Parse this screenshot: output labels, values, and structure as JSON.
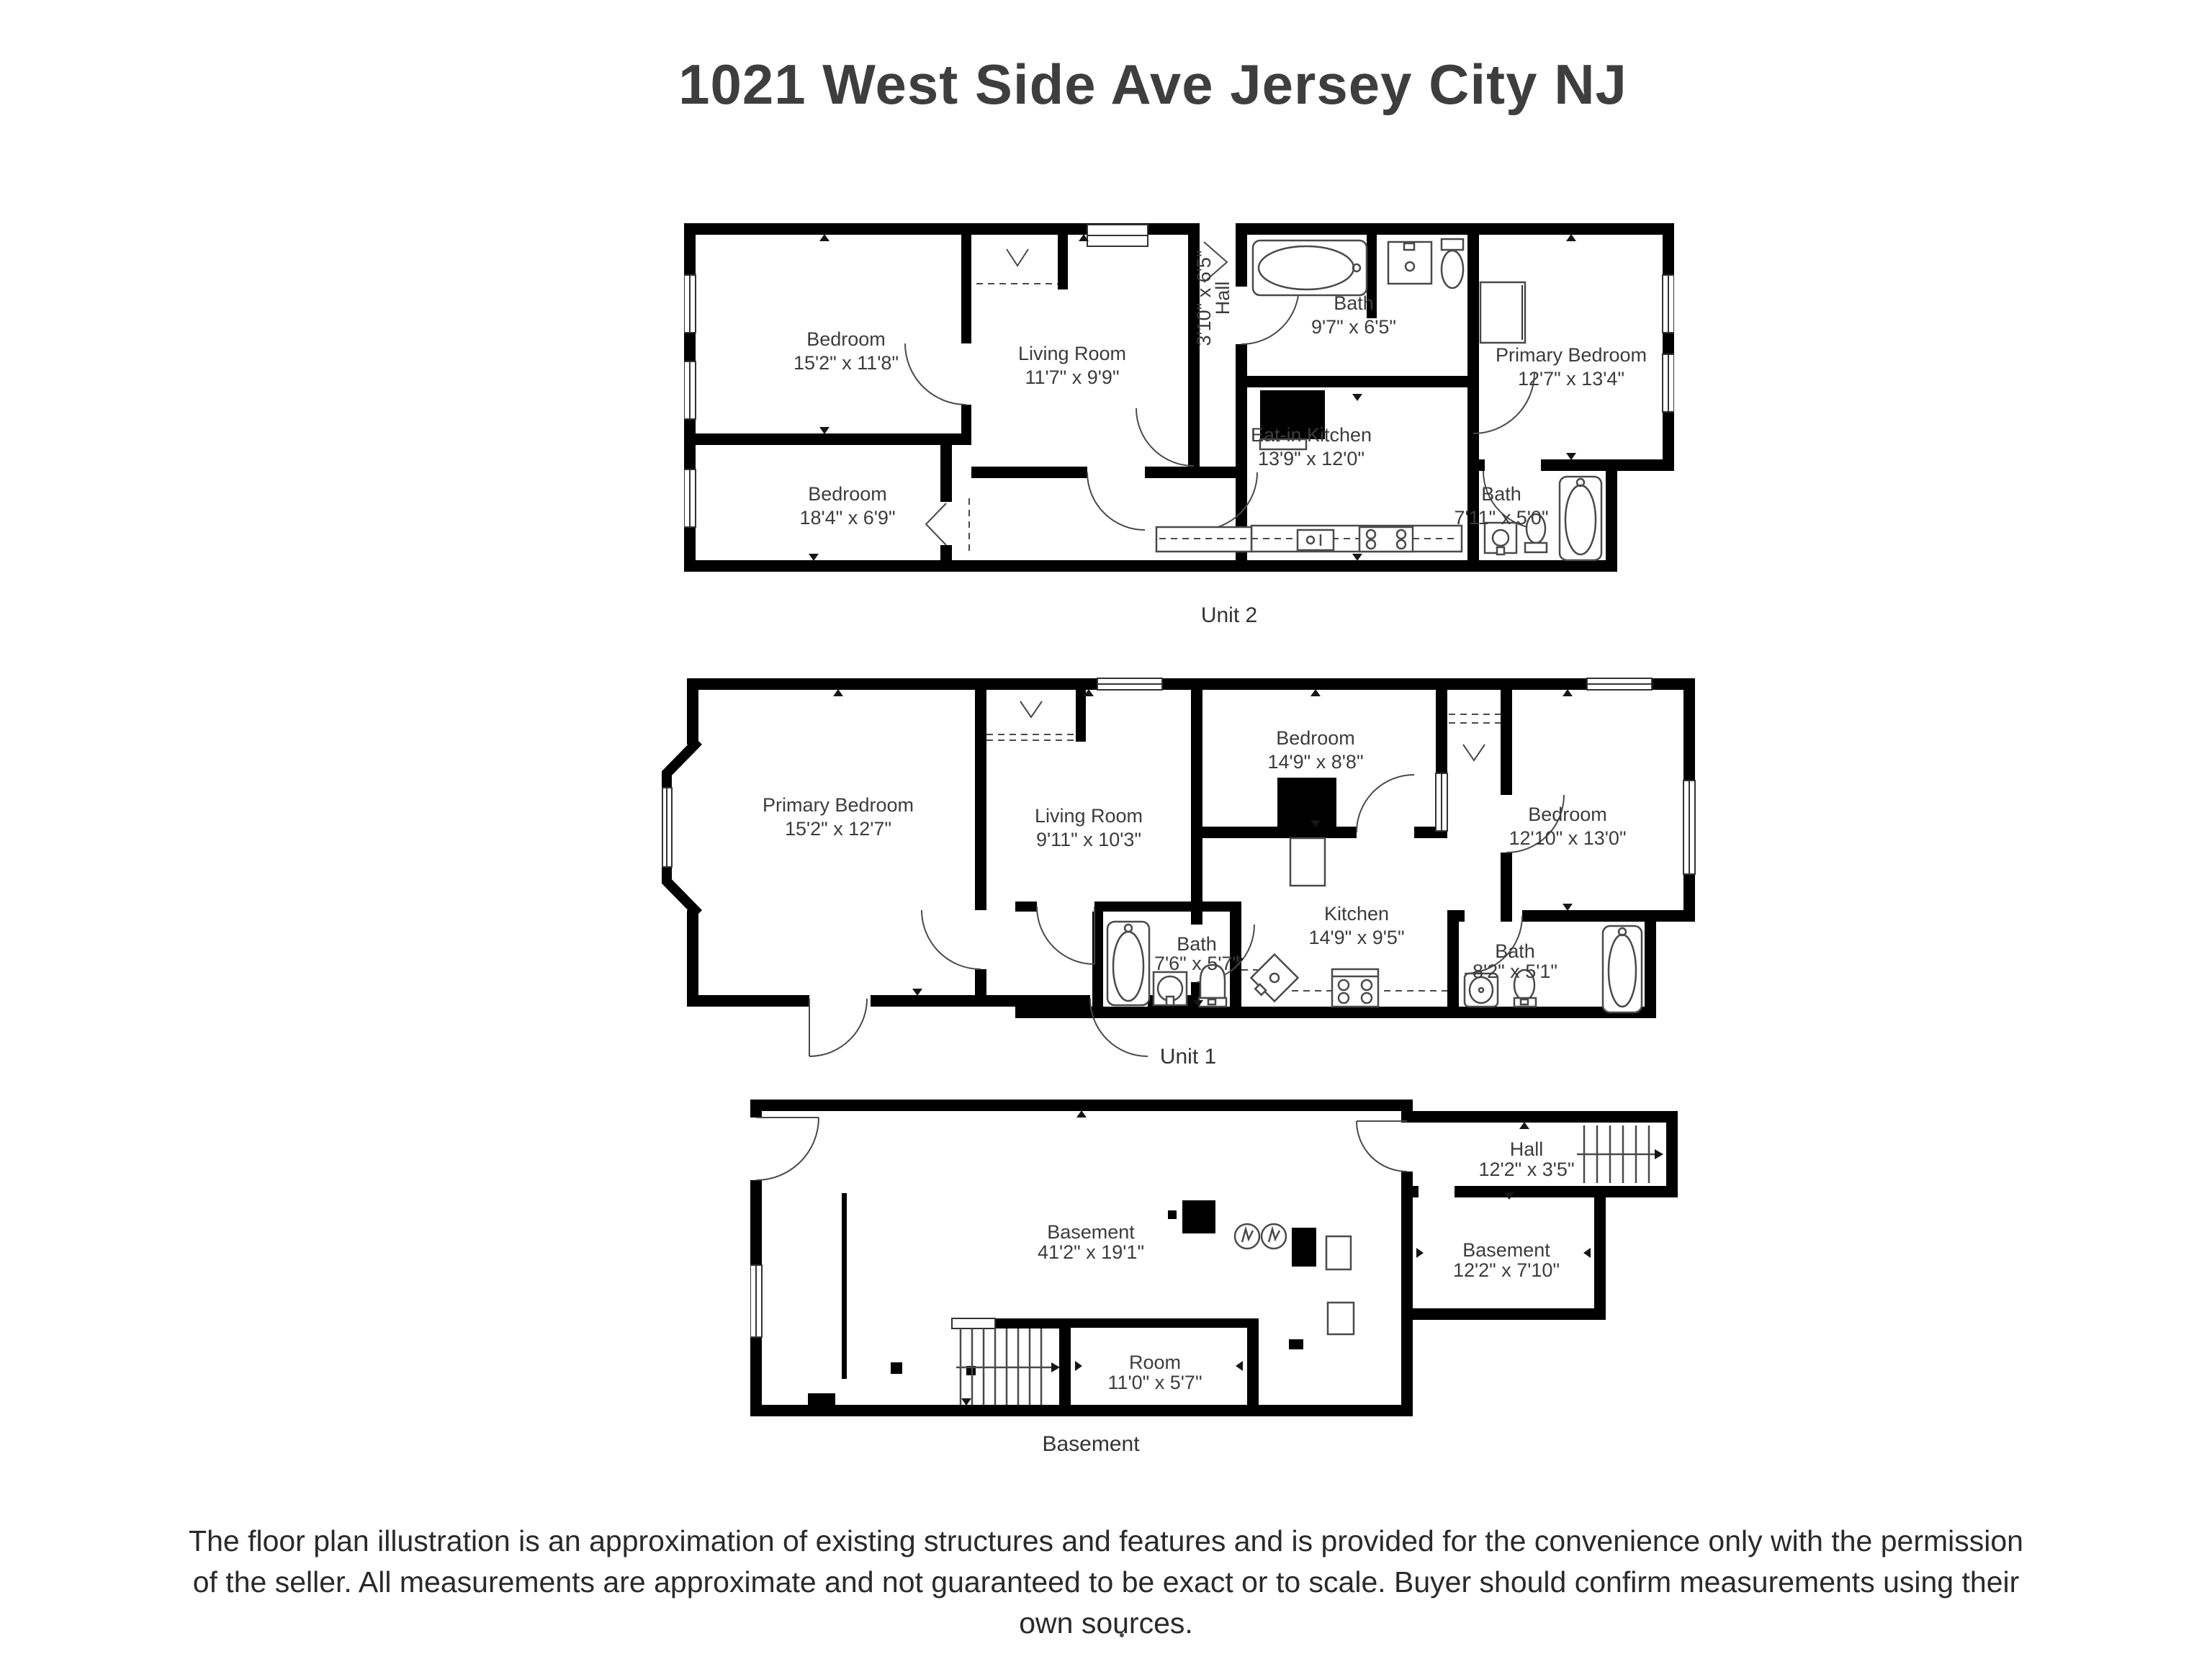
{
  "title": "1021 West Side Ave Jersey City NJ",
  "plans": [
    {
      "label": "Unit 2",
      "rooms": [
        {
          "name": "Bedroom",
          "dims": "15'2\" x 11'8\""
        },
        {
          "name": "Bedroom",
          "dims": "18'4\" x 6'9\""
        },
        {
          "name": "Living Room",
          "dims": "11'7\" x 9'9\""
        },
        {
          "name": "Hall",
          "dims": "3'10\" x 6'5\""
        },
        {
          "name": "Bath",
          "dims": "9'7\" x 6'5\""
        },
        {
          "name": "Eat-in Kitchen",
          "dims": "13'9\" x 12'0\""
        },
        {
          "name": "Primary Bedroom",
          "dims": "12'7\" x 13'4\""
        },
        {
          "name": "Bath",
          "dims": "7'11\" x 5'0\""
        }
      ]
    },
    {
      "label": "Unit 1",
      "rooms": [
        {
          "name": "Primary Bedroom",
          "dims": "15'2\" x 12'7\""
        },
        {
          "name": "Living Room",
          "dims": "9'11\" x 10'3\""
        },
        {
          "name": "Bedroom",
          "dims": "14'9\" x 8'8\""
        },
        {
          "name": "Bedroom",
          "dims": "12'10\" x 13'0\""
        },
        {
          "name": "Kitchen",
          "dims": "14'9\" x 9'5\""
        },
        {
          "name": "Bath",
          "dims": "7'6\" x 5'7\""
        },
        {
          "name": "Bath",
          "dims": "8'2\" x 5'1\""
        }
      ]
    },
    {
      "label": "Basement",
      "rooms": [
        {
          "name": "Basement",
          "dims": "41'2\" x 19'1\""
        },
        {
          "name": "Hall",
          "dims": "12'2\" x 3'5\""
        },
        {
          "name": "Basement",
          "dims": "12'2\" x 7'10\""
        },
        {
          "name": "Room",
          "dims": "11'0\" x 5'7\""
        }
      ]
    }
  ],
  "disclaimer": "The floor plan illustration is an approximation of existing structures and features and is provided for the convenience only with the permission of the seller. All measurements are approximate and not guaranteed to be exact or to scale. Buyer should confirm measurements using their own sources."
}
